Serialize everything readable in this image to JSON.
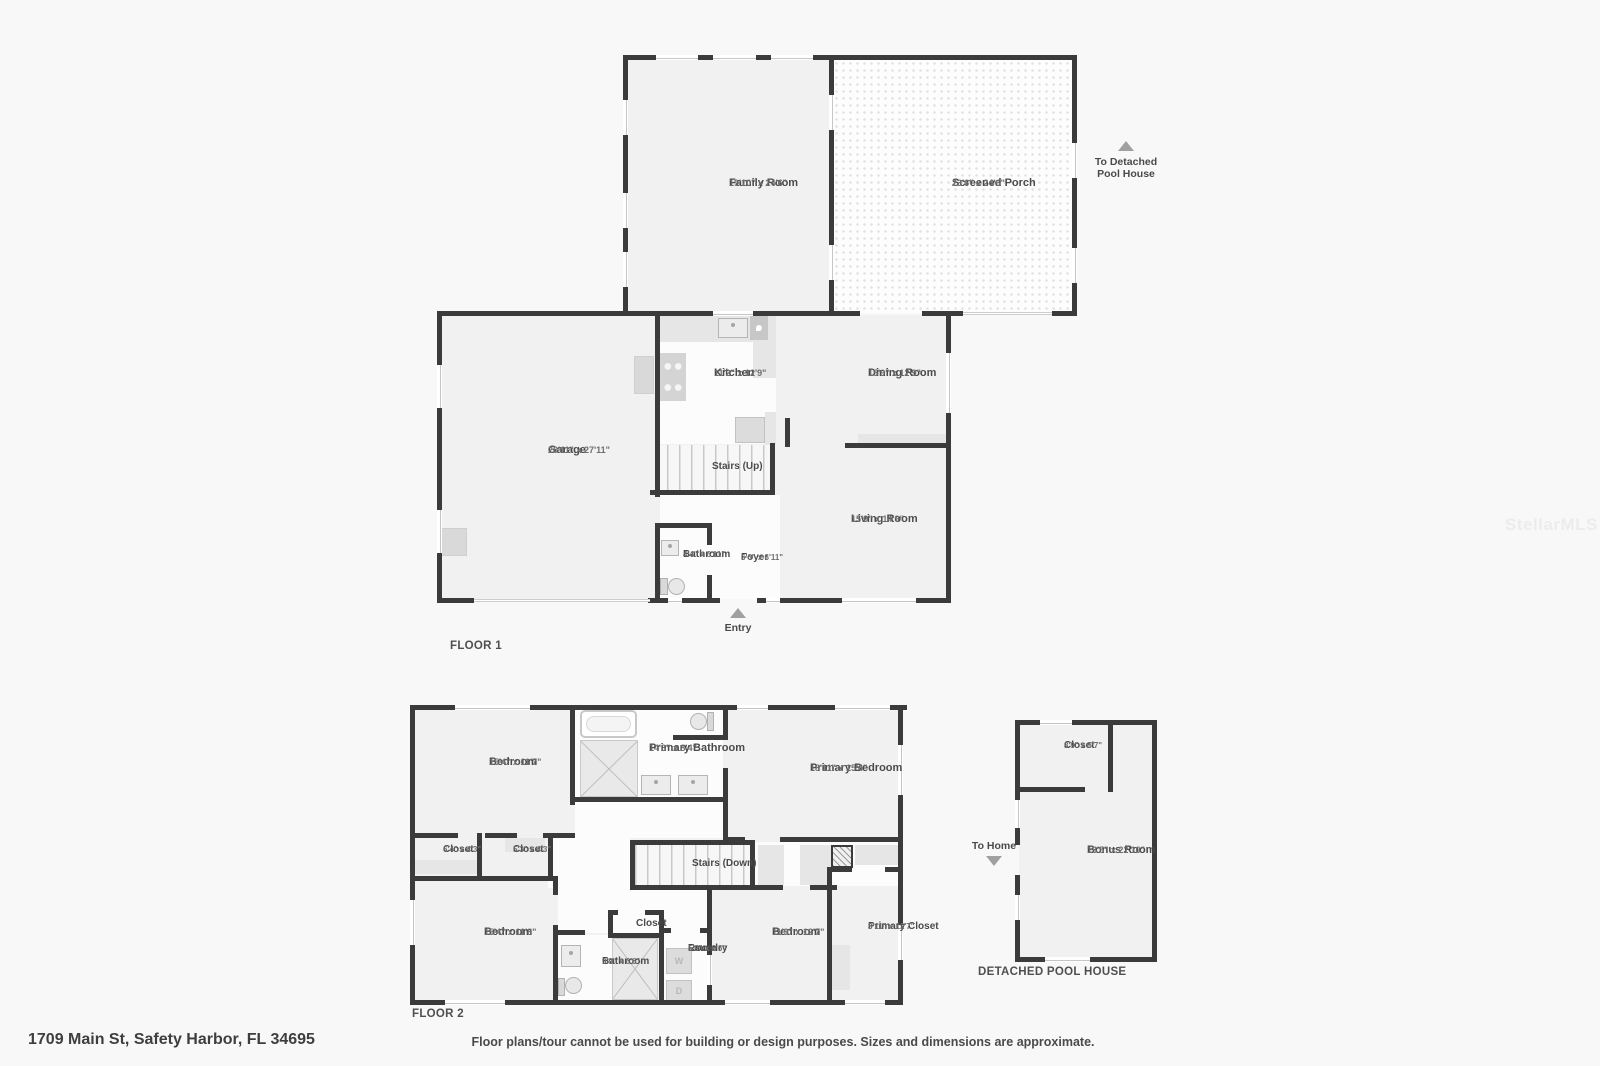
{
  "page": {
    "address": "1709 Main St, Safety Harbor, FL 34695",
    "disclaimer": "Floor plans/tour cannot be used for building or design purposes. Sizes and dimensions are approximate.",
    "watermark": "StellarMLS",
    "colors": {
      "wall": "#3b3b3b",
      "room_fill": "#f1f1f1",
      "porch_fill": "#fdfdfd",
      "counter": "#e6e6e6",
      "marker": "#a0a0a0"
    }
  },
  "floor1": {
    "title": "FLOOR 1",
    "rooms": {
      "family_room": {
        "name": "Family Room",
        "dims": "19'10\" x 24'6\""
      },
      "screened_porch": {
        "name": "Screened Porch",
        "dims": "23'6\" x 24'6\""
      },
      "kitchen": {
        "name": "Kitchen",
        "dims": "11'2\" x 12'9\""
      },
      "dining_room": {
        "name": "Dining Room",
        "dims": "15'9\" x 12'9\""
      },
      "garage": {
        "name": "Garage",
        "dims": "20'11\" x 27'11\""
      },
      "stairs_up": {
        "name": "Stairs (Up)"
      },
      "living_room": {
        "name": "Living Room",
        "dims": "15'9\" x 14'9\""
      },
      "bathroom": {
        "name": "Bathroom",
        "dims": "4'4\" x 6'11\""
      },
      "foyer": {
        "name": "Foyer",
        "dims": "6'6\" x 6'11\""
      }
    },
    "annotations": {
      "to_pool_house_line1": "To Detached",
      "to_pool_house_line2": "Pool House",
      "entry": "Entry"
    }
  },
  "floor2": {
    "title": "FLOOR 2",
    "rooms": {
      "bedroom_top_left": {
        "name": "Bedroom",
        "dims": "15'4\" x 11'7\""
      },
      "primary_bathroom": {
        "name": "Primary Bathroom",
        "dims": "14'3\" x 8'4\""
      },
      "primary_bedroom": {
        "name": "Primary Bedroom",
        "dims": "18'11\" x 15'4\""
      },
      "closet_left": {
        "name": "Closet",
        "dims": "6'4\" x 4'3\""
      },
      "closet_right": {
        "name": "Closet",
        "dims": "5'3\" x 4'3\""
      },
      "stairs_down": {
        "name": "Stairs (Down)"
      },
      "bedroom_bottom_left": {
        "name": "Bedroom",
        "dims": "15'4\" x 11'8\""
      },
      "hall_closet": {
        "name": "Closet"
      },
      "bathroom": {
        "name": "Bathroom",
        "dims": "9'9\" x 6'6\""
      },
      "laundry_room": {
        "name_line1": "Laundry",
        "name_line2": "Room",
        "dims": "5'9\" x 6'6\""
      },
      "bedroom_bottom_right": {
        "name": "Bedroom",
        "dims": "11'9\" x 12'7\""
      },
      "primary_closet": {
        "name": "Primary Closet",
        "dims": "8'11\" x 12'7\""
      }
    },
    "appliances": {
      "washer": "W",
      "dryer": "D"
    }
  },
  "pool_house": {
    "title": "DETACHED POOL HOUSE",
    "rooms": {
      "closet": {
        "name": "Closet",
        "dims": "8'9\" x 5'7\""
      },
      "bonus_room": {
        "name": "Bonus Room",
        "dims": "13'5\" x 22'10\""
      }
    },
    "annotations": {
      "to_home": "To Home"
    }
  }
}
